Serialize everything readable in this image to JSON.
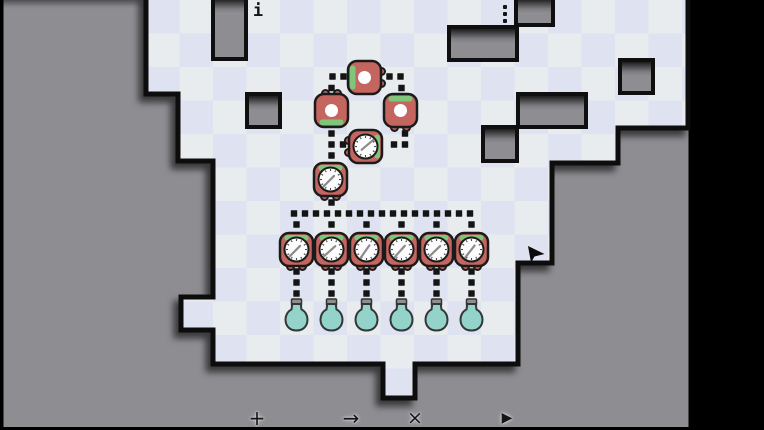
{
  "app": {
    "type": "puzzle-game-board"
  },
  "icons": {
    "info": "i",
    "menu": "kebab-vertical-dots"
  },
  "toolbar": {
    "add": "+",
    "arrow": "→",
    "close": "×",
    "play": "▶"
  },
  "colors": {
    "frame": "#000000",
    "panel": "#8e8d92",
    "tile_light": "#e8ecef",
    "tile_lavender": "#dfe2f0",
    "outline": "#0f0f0f",
    "device_red": "#c4655f",
    "accent_green": "#7ec77a",
    "clock_face": "#fcfcfc",
    "clock_tick": "#4a4a4a",
    "clock_hand": "#8c8c8c",
    "bulb_teal": "#93d3ca",
    "bulb_cap": "#8f8f8f",
    "bulb_stroke": "#323737",
    "dot": "#141414"
  },
  "board": {
    "outline": [
      [
        146,
        -3
      ],
      [
        688,
        -3
      ],
      [
        688,
        128
      ],
      [
        618,
        128
      ],
      [
        618,
        163
      ],
      [
        552,
        163
      ],
      [
        552,
        263
      ],
      [
        518,
        263
      ],
      [
        518,
        364
      ],
      [
        415,
        364
      ],
      [
        415,
        398
      ],
      [
        383,
        398
      ],
      [
        383,
        364
      ],
      [
        213,
        364
      ],
      [
        213,
        330
      ],
      [
        181,
        330
      ],
      [
        181,
        297
      ],
      [
        213,
        297
      ],
      [
        213,
        161
      ],
      [
        178,
        161
      ],
      [
        178,
        94
      ],
      [
        146,
        94
      ]
    ],
    "walls": [
      [
        213,
        -3,
        33,
        62
      ],
      [
        247,
        94,
        33,
        33
      ],
      [
        449,
        27,
        68,
        33
      ],
      [
        516,
        -3,
        37,
        28
      ],
      [
        620,
        60,
        33,
        33
      ],
      [
        518,
        94,
        68,
        33
      ],
      [
        483,
        127,
        34,
        34
      ]
    ],
    "devices": [
      {
        "id": "socket-top",
        "type": "socket",
        "x": 348,
        "y": 61,
        "accent": "left",
        "tabs": "right"
      },
      {
        "id": "socket-left",
        "type": "socket",
        "x": 315,
        "y": 94,
        "accent": "bottom",
        "tabs": "top"
      },
      {
        "id": "socket-right",
        "type": "socket",
        "x": 384,
        "y": 94,
        "accent": "top",
        "tabs": "bottom"
      },
      {
        "id": "clock-mid",
        "type": "clock",
        "x": 349,
        "y": 130,
        "accent": "right",
        "tabs": "left",
        "hand": 50
      },
      {
        "id": "clock-upper",
        "type": "clock",
        "x": 314,
        "y": 163,
        "accent": "top",
        "tabs": "bottom",
        "hand": 225
      },
      {
        "id": "clock-row-1",
        "type": "clock",
        "x": 280,
        "y": 233,
        "accent": "top",
        "tabs": "bottom",
        "hand": 225
      },
      {
        "id": "clock-row-2",
        "type": "clock",
        "x": 315,
        "y": 233,
        "accent": "top",
        "tabs": "bottom",
        "hand": 228
      },
      {
        "id": "clock-row-3",
        "type": "clock",
        "x": 350,
        "y": 233,
        "accent": "top",
        "tabs": "bottom",
        "hand": 215
      },
      {
        "id": "clock-row-4",
        "type": "clock",
        "x": 385,
        "y": 233,
        "accent": "top",
        "tabs": "bottom",
        "hand": 222
      },
      {
        "id": "clock-row-5",
        "type": "clock",
        "x": 420,
        "y": 233,
        "accent": "top",
        "tabs": "bottom",
        "hand": 226
      },
      {
        "id": "clock-row-6",
        "type": "clock",
        "x": 455,
        "y": 233,
        "accent": "top",
        "tabs": "bottom",
        "hand": 218
      }
    ],
    "wire_dots": [
      [
        332.5,
        76.5
      ],
      [
        343.5,
        76.5
      ],
      [
        331.5,
        88
      ],
      [
        389.5,
        76.5
      ],
      [
        400.5,
        76.5
      ],
      [
        401.5,
        88
      ],
      [
        331.5,
        133.5
      ],
      [
        331.5,
        144.5
      ],
      [
        331.5,
        155.5
      ],
      [
        343,
        144.5
      ],
      [
        394,
        144.5
      ],
      [
        405,
        144.5
      ],
      [
        405,
        133.5
      ],
      [
        331.5,
        202.5
      ],
      [
        294,
        213.5
      ],
      [
        305,
        213.5
      ],
      [
        316,
        213.5
      ],
      [
        327,
        213.5
      ],
      [
        338,
        213.5
      ],
      [
        349,
        213.5
      ],
      [
        360,
        213.5
      ],
      [
        371,
        213.5
      ],
      [
        382,
        213.5
      ],
      [
        393,
        213.5
      ],
      [
        404,
        213.5
      ],
      [
        415,
        213.5
      ],
      [
        426,
        213.5
      ],
      [
        437,
        213.5
      ],
      [
        448,
        213.5
      ],
      [
        459,
        213.5
      ],
      [
        470,
        213.5
      ],
      [
        296.5,
        224.5
      ],
      [
        331.5,
        224.5
      ],
      [
        366.5,
        224.5
      ],
      [
        401.5,
        224.5
      ],
      [
        436.5,
        224.5
      ],
      [
        471.5,
        224.5
      ],
      [
        296.5,
        271.5
      ],
      [
        296.5,
        282.5
      ],
      [
        296.5,
        293.5
      ],
      [
        331.5,
        271.5
      ],
      [
        331.5,
        282.5
      ],
      [
        331.5,
        293.5
      ],
      [
        366.5,
        271.5
      ],
      [
        366.5,
        282.5
      ],
      [
        366.5,
        293.5
      ],
      [
        401.5,
        271.5
      ],
      [
        401.5,
        282.5
      ],
      [
        401.5,
        293.5
      ],
      [
        436.5,
        271.5
      ],
      [
        436.5,
        282.5
      ],
      [
        436.5,
        293.5
      ],
      [
        471.5,
        271.5
      ],
      [
        471.5,
        282.5
      ],
      [
        471.5,
        293.5
      ]
    ],
    "bulb_columns": [
      296.5,
      331.5,
      366.5,
      401.5,
      436.5,
      471.5
    ],
    "bulb_y": 318,
    "cursor": [
      528,
      246
    ]
  }
}
